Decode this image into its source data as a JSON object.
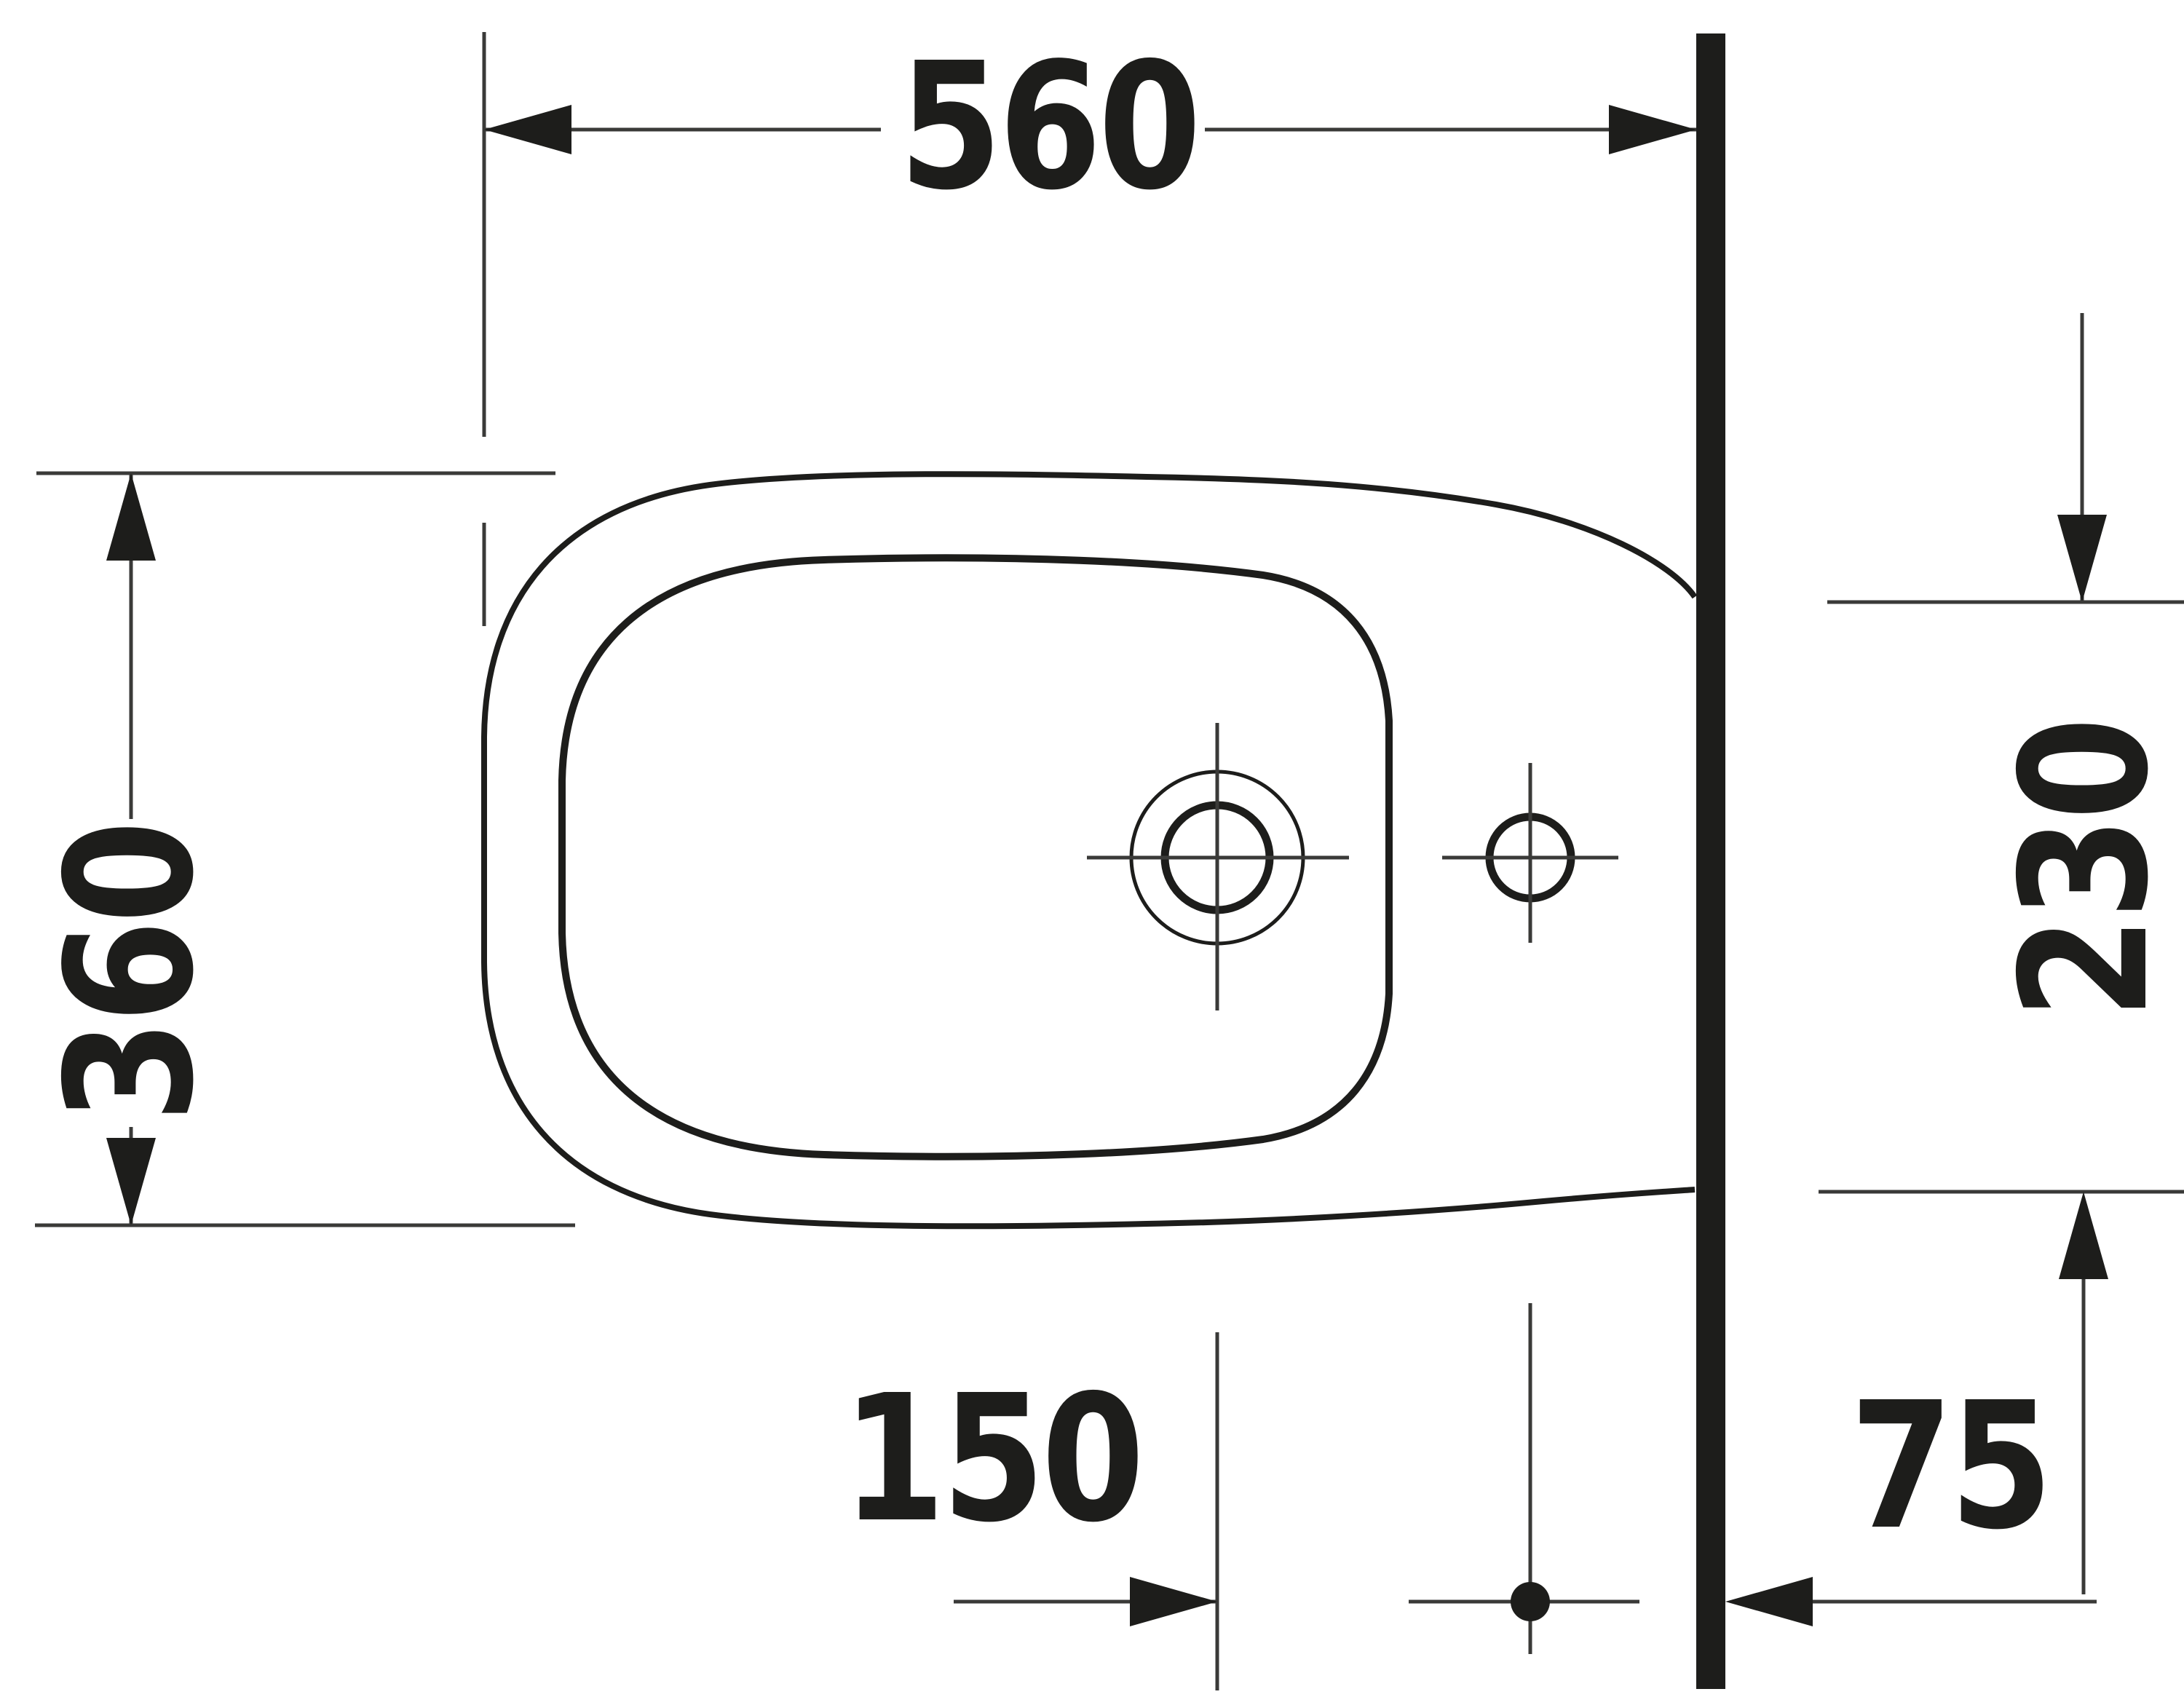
{
  "drawing": {
    "type": "technical-dimension-drawing",
    "subject": "bidet-plan-view",
    "units": "mm",
    "colors": {
      "background": "#ffffff",
      "outline": "#1d1d1b",
      "thin_line": "#3a3a38",
      "wall": "#1d1d1b"
    },
    "dimensions": {
      "overall_depth": {
        "value": "560",
        "orientation": "horizontal"
      },
      "overall_width": {
        "value": "360",
        "orientation": "vertical"
      },
      "outlet_width_at_wall": {
        "value": "230",
        "orientation": "vertical"
      },
      "hole_spacing": {
        "value": "150",
        "orientation": "horizontal"
      },
      "wall_offset": {
        "value": "75",
        "orientation": "horizontal"
      }
    }
  }
}
